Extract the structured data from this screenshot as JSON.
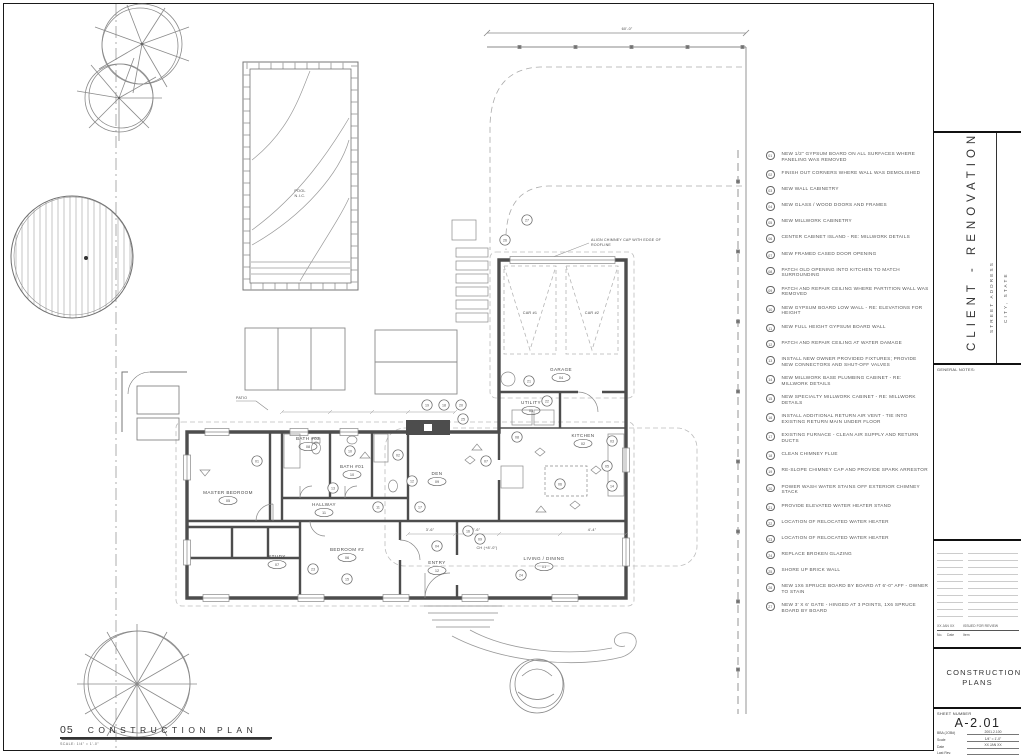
{
  "sheet": {
    "view_number": "05",
    "view_title": "CONSTRUCTION PLAN",
    "view_scale": "SCALE: 1/4\" = 1'-0\"",
    "top_dimension": "60'-0\""
  },
  "title_block": {
    "project_name": "CLIENT - RENOVATION",
    "street_address": "STREET ADDRESS",
    "city_state": "CITY, STATE",
    "general_notes_label": "GENERAL NOTES:",
    "revision": {
      "no_header": "No.",
      "date_header": "Date",
      "item_header": "Item",
      "date": "XX JAN XX",
      "item": "ISSUED FOR REVIEW"
    },
    "set_title": "CONSTRUCTION PLANS",
    "sheet_number_label": "SHEET NUMBER",
    "sheet_number": "A-2.01",
    "fields": [
      {
        "label": "BBA (JOB#)",
        "value": "2001.2.100"
      },
      {
        "label": "Scale",
        "value": "1/4\" = 1'-0\""
      },
      {
        "label": "Date",
        "value": "XX JAN XX"
      },
      {
        "label": "Last Rev.",
        "value": ""
      }
    ]
  },
  "plan": {
    "pool": {
      "line1": "POOL",
      "line2": "N.I.C."
    },
    "chimney_note_line1": "ALIGN CHIMNEY CAP WITH EDGE OF",
    "chimney_note_line2": "ROOFLINE",
    "ceiling_note": "CH (+8'-0\")",
    "patio_label": "PATIO",
    "car_labels": [
      "CAR #1",
      "CAR #2"
    ],
    "dims": [
      "3'-6\"",
      "2'-6\"",
      "4'-4\""
    ],
    "rooms": [
      {
        "name": "LIVING / DINING",
        "tag": "01",
        "x": 544,
        "y": 560
      },
      {
        "name": "KITCHEN",
        "tag": "02",
        "x": 583,
        "y": 437
      },
      {
        "name": "UTILITY",
        "tag": "03",
        "x": 531,
        "y": 404
      },
      {
        "name": "GARAGE",
        "tag": "04",
        "x": 561,
        "y": 371
      },
      {
        "name": "MASTER BEDROOM",
        "tag": "05",
        "x": 228,
        "y": 494
      },
      {
        "name": "BEDROOM #2",
        "tag": "06",
        "x": 347,
        "y": 551
      },
      {
        "name": "STUDY",
        "tag": "07",
        "x": 277,
        "y": 558
      },
      {
        "name": "BATH #02",
        "tag": "08",
        "x": 308,
        "y": 440
      },
      {
        "name": "DEN",
        "tag": "09",
        "x": 437,
        "y": 475
      },
      {
        "name": "BATH #01",
        "tag": "10",
        "x": 352,
        "y": 468
      },
      {
        "name": "HALLWAY",
        "tag": "11",
        "x": 324,
        "y": 506
      },
      {
        "name": "ENTRY",
        "tag": "12",
        "x": 437,
        "y": 564
      }
    ],
    "keynote_flags": [
      {
        "num": "27",
        "x": 527,
        "y": 220
      },
      {
        "num": "26",
        "x": 505,
        "y": 240
      },
      {
        "num": "19",
        "x": 427,
        "y": 405
      },
      {
        "num": "18",
        "x": 444,
        "y": 405
      },
      {
        "num": "20",
        "x": 461,
        "y": 405
      },
      {
        "num": "25",
        "x": 463,
        "y": 419
      },
      {
        "num": "21",
        "x": 529,
        "y": 381
      },
      {
        "num": "22",
        "x": 547,
        "y": 401
      },
      {
        "num": "08",
        "x": 517,
        "y": 437
      },
      {
        "num": "03",
        "x": 612,
        "y": 441
      },
      {
        "num": "05",
        "x": 607,
        "y": 466
      },
      {
        "num": "14",
        "x": 612,
        "y": 486
      },
      {
        "num": "06",
        "x": 560,
        "y": 484
      },
      {
        "num": "13",
        "x": 333,
        "y": 488
      },
      {
        "num": "01",
        "x": 257,
        "y": 461
      },
      {
        "num": "10",
        "x": 350,
        "y": 451
      },
      {
        "num": "02",
        "x": 398,
        "y": 455
      },
      {
        "num": "12",
        "x": 412,
        "y": 481
      },
      {
        "num": "17",
        "x": 420,
        "y": 507
      },
      {
        "num": "07",
        "x": 486,
        "y": 461
      },
      {
        "num": "11",
        "x": 378,
        "y": 507
      },
      {
        "num": "16",
        "x": 468,
        "y": 531
      },
      {
        "num": "09",
        "x": 480,
        "y": 539
      },
      {
        "num": "04",
        "x": 437,
        "y": 546
      },
      {
        "num": "24",
        "x": 521,
        "y": 575
      },
      {
        "num": "23",
        "x": 313,
        "y": 569
      },
      {
        "num": "15",
        "x": 347,
        "y": 579
      }
    ]
  },
  "keynotes": [
    {
      "num": "01",
      "text": "NEW 1/2\" GYPSUM BOARD ON ALL SURFACES WHERE PANELING WAS REMOVED"
    },
    {
      "num": "02",
      "text": "FINISH OUT CORNERS WHERE WALL WAS DEMOLISHED"
    },
    {
      "num": "03",
      "text": "NEW WALL CABINETRY"
    },
    {
      "num": "04",
      "text": "NEW GLASS / WOOD DOORS AND FRAMES"
    },
    {
      "num": "05",
      "text": "NEW MILLWORK CABINETRY"
    },
    {
      "num": "06",
      "text": "CENTER CABINET ISLAND - RE: MILLWORK DETAILS"
    },
    {
      "num": "07",
      "text": "NEW FRAMED CASED DOOR OPENING"
    },
    {
      "num": "08",
      "text": "PATCH OLD OPENING INTO KITCHEN TO MATCH SURROUNDING"
    },
    {
      "num": "09",
      "text": "PATCH AND REPAIR CEILING WHERE PARTITION WALL WAS REMOVED"
    },
    {
      "num": "10",
      "text": "NEW GYPSUM BOARD LOW WALL - RE: ELEVATIONS FOR HEIGHT"
    },
    {
      "num": "11",
      "text": "NEW FULL HEIGHT GYPSUM BOARD WALL"
    },
    {
      "num": "12",
      "text": "PATCH AND REPAIR CEILING AT WATER DAMAGE"
    },
    {
      "num": "13",
      "text": "INSTALL NEW OWNER PROVIDED FIXTURES; PROVIDE NEW CONNECTORS AND SHUT-OFF VALVES"
    },
    {
      "num": "14",
      "text": "NEW MILLWORK BASE PLUMBING CABINET - RE: MILLWORK DETAILS"
    },
    {
      "num": "15",
      "text": "NEW SPECIALTY MILLWORK CABINET - RE: MILLWORK DETAILS"
    },
    {
      "num": "16",
      "text": "INSTALL ADDITIONAL RETURN AIR VENT - TIE INTO EXISTING RETURN MAIN UNDER FLOOR"
    },
    {
      "num": "17",
      "text": "EXISTING FURNACE - CLEAN AIR SUPPLY AND RETURN DUCTS"
    },
    {
      "num": "18",
      "text": "CLEAN CHIMNEY FLUE"
    },
    {
      "num": "19",
      "text": "RE-SLOPE CHIMNEY CAP AND PROVIDE SPARK ARRESTOR"
    },
    {
      "num": "20",
      "text": "POWER WASH WATER STAINS OFF EXTERIOR CHIMNEY STACK"
    },
    {
      "num": "21",
      "text": "PROVIDE ELEVATED WATER HEATER STAND"
    },
    {
      "num": "22",
      "text": "LOCATION OF RELOCATED WATER HEATER"
    },
    {
      "num": "23",
      "text": "LOCATION OF RELOCATED WATER HEATER"
    },
    {
      "num": "24",
      "text": "REPLACE BROKEN GLAZING"
    },
    {
      "num": "25",
      "text": "SHORE UP BRICK WALL"
    },
    {
      "num": "26",
      "text": "NEW 1x6 SPRUCE BOARD BY BOARD AT 6'-0\" AFF - OWNER TO STAIN"
    },
    {
      "num": "27",
      "text": "NEW 3' x 6' GATE - HINGED AT 3 POINTS, 1x6 SPRUCE BOARD BY BOARD"
    }
  ]
}
